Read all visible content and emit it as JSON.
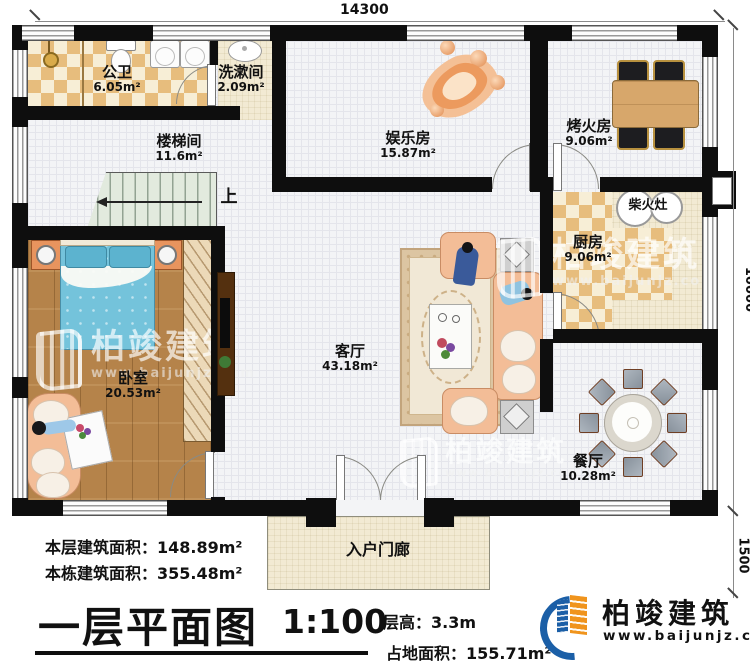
{
  "dims": {
    "top": "14300",
    "right_main": "10000",
    "right_porch": "1500"
  },
  "rooms": {
    "gongwei": {
      "name": "公卫",
      "area": "6.05m²"
    },
    "xishujian": {
      "name": "洗漱间",
      "area": "2.09m²"
    },
    "loutijian": {
      "name": "楼梯间",
      "area": "11.6m²"
    },
    "yulefang": {
      "name": "娱乐房",
      "area": "15.87m²"
    },
    "kaohuofang": {
      "name": "烤火房",
      "area": "9.06m²"
    },
    "chufang": {
      "name": "厨房",
      "area": "9.06m²"
    },
    "woshi": {
      "name": "卧室",
      "area": "20.53m²"
    },
    "keting": {
      "name": "客厅",
      "area": "43.18m²"
    },
    "canting": {
      "name": "餐厅",
      "area": "10.28m²"
    },
    "menlang": {
      "name": "入户门廊"
    }
  },
  "annotations": {
    "stove": "柴火灶",
    "stairs_up": "上"
  },
  "footer": {
    "floor_area_label": "本层建筑面积：",
    "floor_area_value": "148.89m²",
    "building_area_label": "本栋建筑面积：",
    "building_area_value": "355.48m²",
    "title": "一层平面图",
    "scale": "1:100",
    "height_label": "层高：",
    "height_value": "3.3m",
    "land_label": "占地面积：",
    "land_value": "155.71m²"
  },
  "brand": {
    "company": "柏竣建筑",
    "website": "www.baijunjz.com"
  },
  "colors": {
    "wall": "#0e0e0e",
    "tile_check": "#e7bd7d",
    "wood": "#b5834a",
    "bed": "#74c3db",
    "sofa": "#f3bd97",
    "logo_blue": "#1b5fa7",
    "logo_orange": "#f0941d"
  }
}
